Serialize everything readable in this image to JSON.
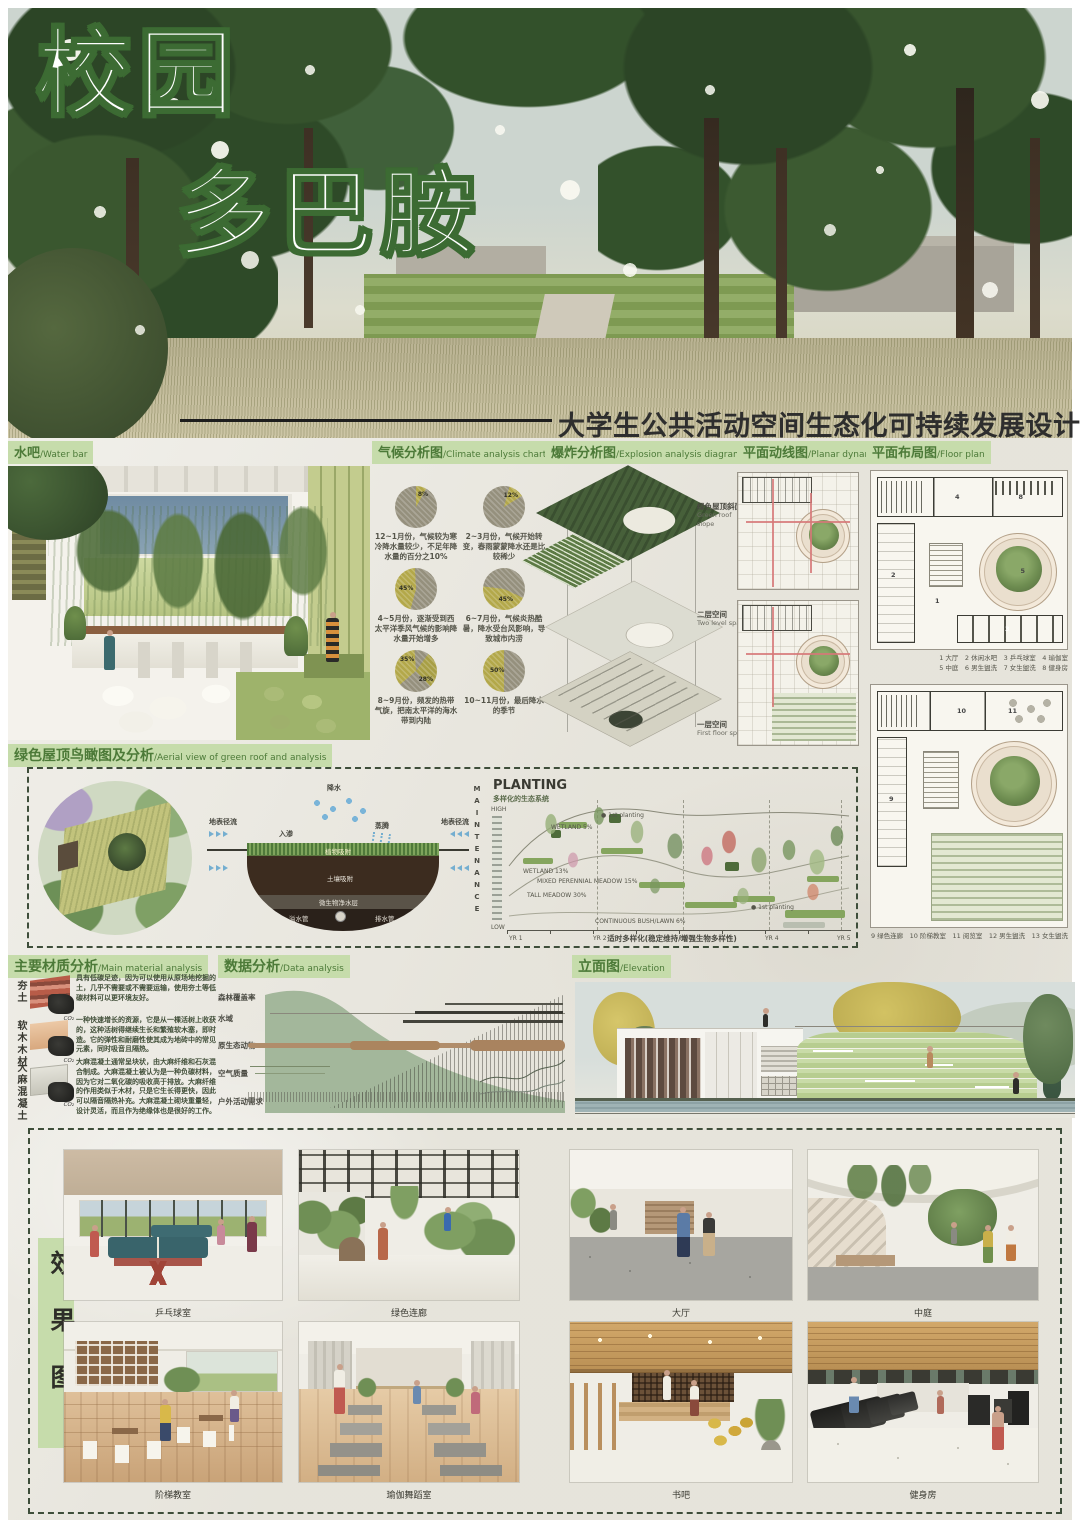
{
  "poster": {
    "title_line1": "校园",
    "title_line2": "多巴胺",
    "subtitle": "大学生公共活动空间生态化可持续发展设计"
  },
  "labels": {
    "water_bar": {
      "zh": "水吧",
      "en": "/Water bar"
    },
    "climate": {
      "zh": "气候分析图",
      "en": "/Climate analysis chart"
    },
    "explosion": {
      "zh": "爆炸分析图",
      "en": "/Explosion analysis diagram"
    },
    "planar": {
      "zh": "平面动线图",
      "en": "/Planar dynamic"
    },
    "floorplan": {
      "zh": "平面布局图",
      "en": "/Floor plan"
    },
    "greenroof": {
      "zh": "绿色屋顶鸟瞰图及分析",
      "en": "/Aerial view of green roof and analysis"
    },
    "material": {
      "zh": "主要材质分析",
      "en": "/Main material analysis"
    },
    "data": {
      "zh": "数据分析",
      "en": "/Data analysis"
    },
    "elevation": {
      "zh": "立面图",
      "en": "/Elevation"
    },
    "effect": "效果图"
  },
  "climate": {
    "pies": [
      {
        "value": "8%",
        "caption": "12~1月份，气候较为寒冷降水量较少，不足年降水量的百分之10%"
      },
      {
        "value": "12%",
        "caption": "2~3月份，气候开始转变，春雨蒙蒙降水还是比较稀少"
      },
      {
        "value": "45%",
        "caption": "4~5月份，逐渐受到西太平洋季风气候的影响降水量开始增多"
      },
      {
        "value": "45%",
        "caption": "6~7月份，气候炎热酷暑，降水受台风影响，导致城市内涝"
      },
      {
        "value": "35%",
        "value2": "28%",
        "caption": "8~9月份，频发的热带气旋，把南太平洋的海水带到内陆"
      },
      {
        "value": "50%",
        "caption": "10~11月份，最后降水的季节"
      }
    ]
  },
  "explosion": {
    "layer1": {
      "zh": "绿色屋顶斜面",
      "en": "Green roof slope"
    },
    "layer2": {
      "zh": "二层空间",
      "en": "Two level space"
    },
    "layer3": {
      "zh": "一层空间",
      "en": "First floor space"
    }
  },
  "floorplan": {
    "legend1a": "1 大厅　2 休闲水吧　3 乒乓球室　4 瑜伽室",
    "legend1b": "5 中庭　6 男生盥洗　7 女生盥洗　8 健身房",
    "legend2": "9 绿色连廊　10 阶梯教室　11 阅览室　12 男生盥洗　13 女生盥洗",
    "nums": [
      "1",
      "2",
      "3",
      "4",
      "5",
      "8",
      "9",
      "10",
      "11"
    ]
  },
  "raingarden": {
    "rain": "降水",
    "runoff_left": "地表径流",
    "runoff_right": "地表径流",
    "infiltration": "入渗",
    "evaporation": "蒸腾",
    "layer_plant": "植物吸附",
    "layer_soil": "土壤吸附",
    "layer_microbe": "微生物净水层",
    "overflow_pipe": "溢水管",
    "drain_pipe": "排水管",
    "maintenance": "MAINTENANCE"
  },
  "planting": {
    "title": "PLANTING",
    "subtitle": "多样化的生态系统",
    "high": "HIGH",
    "low": "LOW",
    "years": [
      "YR 1",
      "YR 2",
      "YR 3",
      "YR 4",
      "YR 5"
    ],
    "ann_wetland5": "WETLAND 5%",
    "ann_wetland13": "WETLAND 13%",
    "ann_meadow": "MIXED PERENNIAL MEADOW 15%",
    "ann_tall": "TALL MEADOW 30%",
    "ann_bush": "CONTINUOUS BUSH/LAWN 6%",
    "first_planting": "● 1st planting",
    "caption": "适时多样化(稳定维持/增强生物多样性)"
  },
  "materials": {
    "items": [
      {
        "name": "夯土",
        "co2": "CO₂",
        "text": "具有低碳足迹，因为可以使用从原场地挖掘的土，几乎不需要或不需要运输，使用夯土等低碳材料可以更环境友好。"
      },
      {
        "name": "软木木材",
        "co2": "CO₂",
        "text": "一种快速增长的资源，它是从一棵活树上收获的，这种活树得继续生长和繁殖软木塞，即时造。它的弹性和耐磨性使其成为地砖中的常见元素，同时吸音且隔热。"
      },
      {
        "name": "大麻混凝土",
        "co2": "CO₂",
        "text": "大麻混凝土通常呈块状，由大麻纤维和石灰混合制成。大麻混凝土被认为是一种负碳材料，因为它对二氧化碳的吸收高于排放。大麻纤维的作用类似于木材，只是它生长得更快，因此可以隔音隔热补充。大麻混凝土砌块重量轻，设计灵活，而且作为绝缘体也是很好的工作。"
      }
    ]
  },
  "data_analysis": {
    "rows": [
      "森林覆盖率",
      "水域",
      "原生态动物",
      "空气质量",
      "户外活动需求"
    ]
  },
  "effects": {
    "row1": [
      "乒乓球室",
      "绿色连廊",
      "大厅",
      "中庭"
    ],
    "row2": [
      "阶梯教室",
      "瑜伽舞蹈室",
      "书吧",
      "健身房"
    ]
  },
  "chart_data": [
    {
      "type": "pie",
      "title": "12~1月降水占比",
      "slices": [
        {
          "label": "降水",
          "value": 8
        },
        {
          "label": "其他",
          "value": 92
        }
      ]
    },
    {
      "type": "pie",
      "title": "2~3月降水占比",
      "slices": [
        {
          "label": "降水",
          "value": 12
        },
        {
          "label": "其他",
          "value": 88
        }
      ]
    },
    {
      "type": "pie",
      "title": "4~5月降水占比",
      "slices": [
        {
          "label": "降水",
          "value": 45
        },
        {
          "label": "其他",
          "value": 55
        }
      ]
    },
    {
      "type": "pie",
      "title": "6~7月降水占比",
      "slices": [
        {
          "label": "降水",
          "value": 45
        },
        {
          "label": "其他",
          "value": 55
        }
      ]
    },
    {
      "type": "pie",
      "title": "8~9月降水占比",
      "slices": [
        {
          "label": "降水A",
          "value": 35
        },
        {
          "label": "降水B",
          "value": 28
        },
        {
          "label": "其他",
          "value": 37
        }
      ]
    },
    {
      "type": "pie",
      "title": "10~11月降水占比",
      "slices": [
        {
          "label": "降水",
          "value": 50
        },
        {
          "label": "其他",
          "value": 50
        }
      ]
    },
    {
      "type": "area",
      "title": "PLANTING 多样化的生态系统",
      "x": [
        "YR 1",
        "YR 2",
        "YR 3",
        "YR 4",
        "YR 5"
      ],
      "ylabel": "HIGH → LOW",
      "annotations": [
        "WETLAND 5%",
        "WETLAND 13%",
        "MIXED PERENNIAL MEADOW 15%",
        "TALL MEADOW 30%",
        "CONTINUOUS BUSH/LAWN 6%",
        "1st planting ×2"
      ],
      "caption": "适时多样化(稳定维持/增强生物多样性)"
    },
    {
      "type": "area",
      "title": "数据分析",
      "categories": [
        "森林覆盖率",
        "水域",
        "原生态动物",
        "空气质量",
        "户外活动需求"
      ],
      "trends": {
        "森林覆盖率": "随时间下降",
        "户外活动需求": "随时间上升"
      }
    }
  ]
}
